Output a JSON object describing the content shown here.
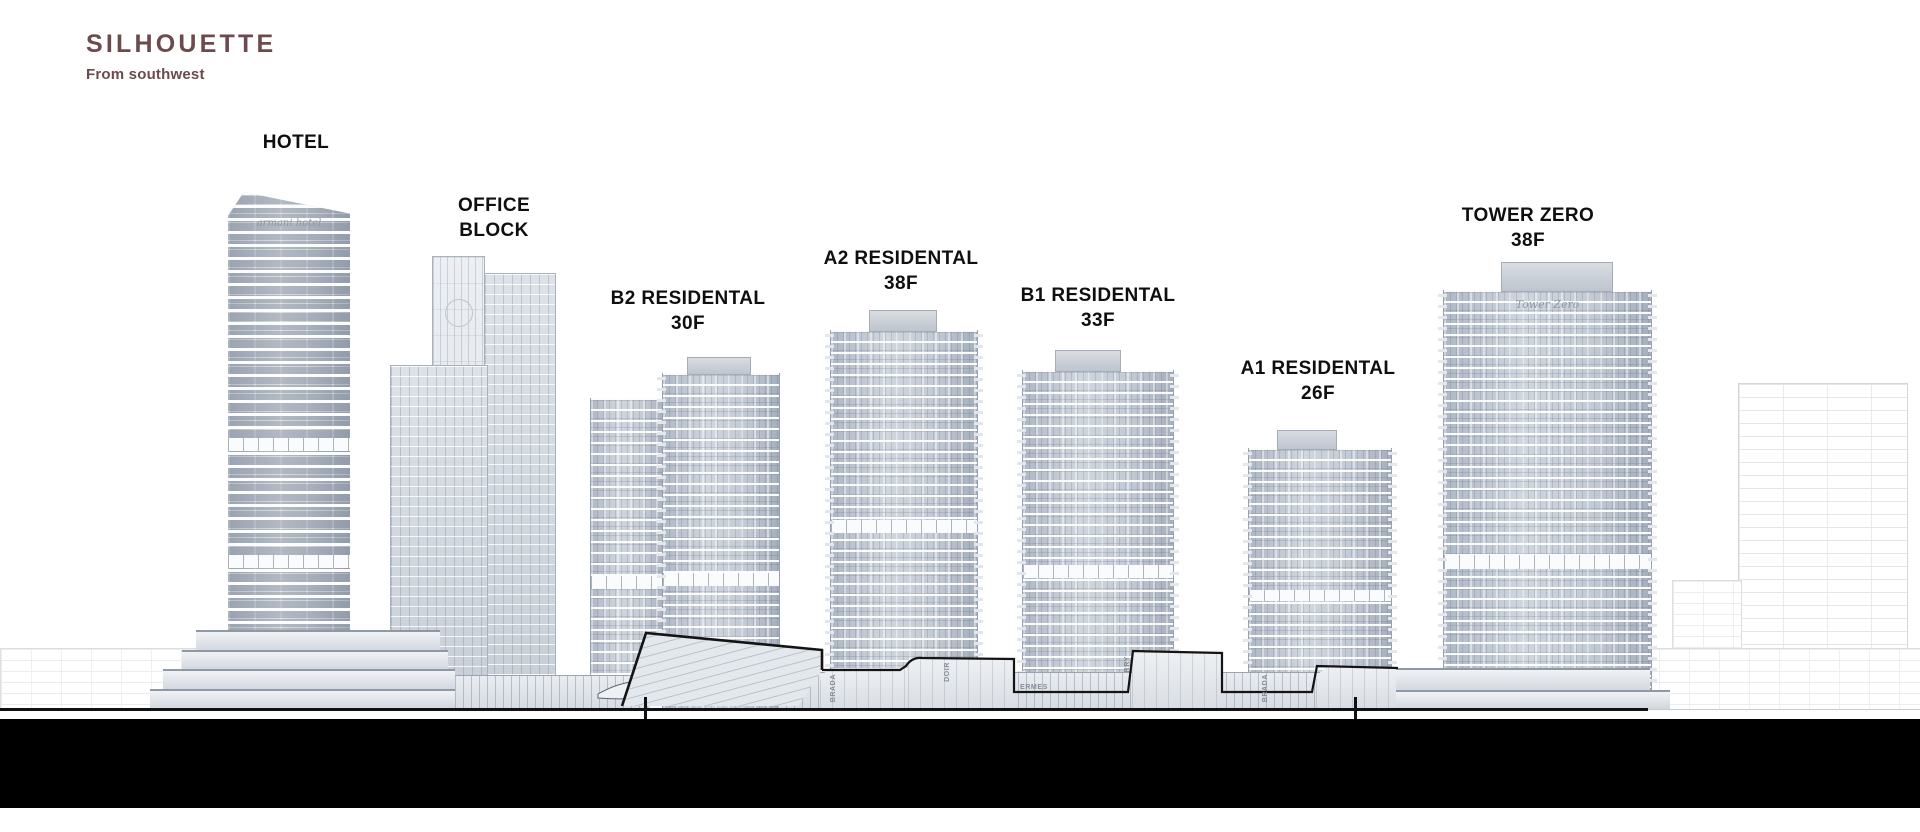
{
  "header": {
    "title": "SILHOUETTE",
    "subtitle": "From southwest"
  },
  "colors": {
    "accent": "#6d4a4d",
    "label": "#0f0f0f",
    "band": "#000000",
    "facade": "#c6cdd8"
  },
  "buildings": [
    {
      "key": "hotel",
      "line1": "HOTEL",
      "line2": "",
      "sign": "armani hotel"
    },
    {
      "key": "office-block",
      "line1": "OFFICE",
      "line2": "BLOCK",
      "sign": ""
    },
    {
      "key": "b2-residental",
      "line1": "B2 RESIDENTAL",
      "line2": "30F",
      "sign": ""
    },
    {
      "key": "a2-residental",
      "line1": "A2 RESIDENTAL",
      "line2": "38F",
      "sign": ""
    },
    {
      "key": "b1-residental",
      "line1": "B1 RESIDENTAL",
      "line2": "33F",
      "sign": ""
    },
    {
      "key": "a1-residental",
      "line1": "A1 RESIDENTAL",
      "line2": "26F",
      "sign": ""
    },
    {
      "key": "tower-zero",
      "line1": "TOWER ZERO",
      "line2": "38F",
      "sign": "Tower Zero"
    }
  ],
  "podium_signs": [
    {
      "text": "BRADA",
      "orientation": "vertical"
    },
    {
      "text": "DOIR",
      "orientation": "vertical"
    },
    {
      "text": "ERMES",
      "orientation": "horizontal"
    },
    {
      "text": "RRY",
      "orientation": "vertical"
    },
    {
      "text": "BRADA",
      "orientation": "vertical"
    }
  ]
}
